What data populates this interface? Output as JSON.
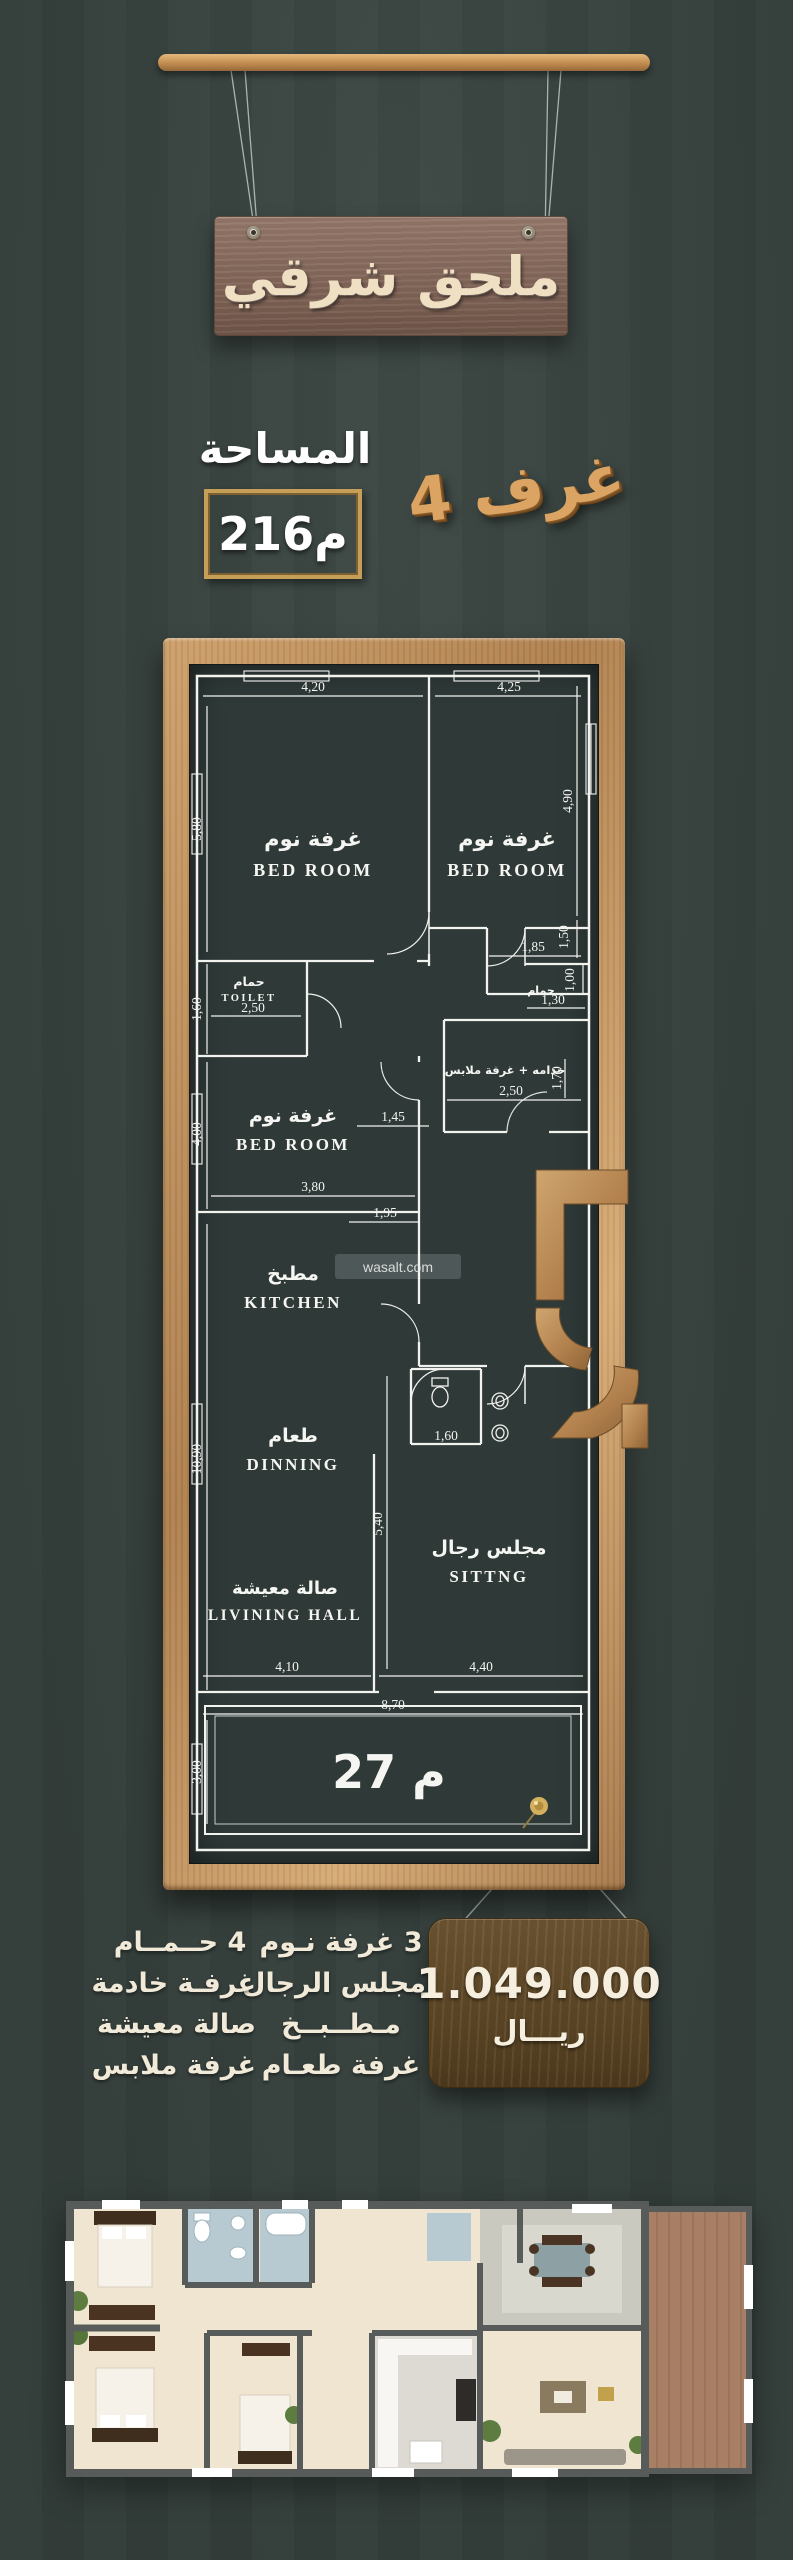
{
  "header": {
    "sign_text": "ملحق شرقي"
  },
  "area": {
    "label": "المساحة",
    "value": "216م"
  },
  "rooms_count": "4 غرف",
  "plan": {
    "rooms": {
      "bed1_ar": "غرفة نوم",
      "bed1_en": "BED ROOM",
      "bed2_ar": "غرفة نوم",
      "bed2_en": "BED ROOM",
      "toilet_ar": "حمام",
      "toilet_en": "TOILET",
      "bath2_ar": "حمام",
      "maid_ar": "خدامه + غرفة ملابس",
      "bed3_ar": "غرفة نوم",
      "bed3_en": "BED ROOM",
      "kitchen_ar": "مطبخ",
      "kitchen_en": "KITCHEN",
      "dining_ar": "طعام",
      "dining_en": "DINNING",
      "sitting_ar": "مجلس رجال",
      "sitting_en": "SITTNG",
      "living_ar": "صالة معيشة",
      "living_en": "LIVINING HALL"
    },
    "dims": {
      "d420": "4,20",
      "d425": "4,25",
      "d580": "5,80",
      "d490": "4,90",
      "d150": "1,50",
      "d160t": "1,60",
      "d250t": "2,50",
      "d185": "1,85",
      "d130": "1,30",
      "d100": "1,00",
      "d250m": "2,50",
      "d170": "1,70",
      "d400": "4,00",
      "d145": "1,45",
      "d380": "3,80",
      "d195": "1,95",
      "d1090": "10,90",
      "d160w": "1,60",
      "d540": "5,40",
      "d410": "4,10",
      "d440": "4,40",
      "d870": "8,70",
      "d300": "3,00"
    },
    "terrace_label": "27 م",
    "watermark": "wasalt.com"
  },
  "features": {
    "col1": [
      "3 غرفة نـوم",
      "مجلس الرجال",
      "مـطــبــخ",
      "غرفة طعـام"
    ],
    "col2": [
      "4 حــمــام",
      "غرفـة خادمة",
      "صالة معيشة",
      "غرفة ملابس"
    ]
  },
  "price": {
    "amount": "1.049.000",
    "currency": "ريـــال"
  }
}
